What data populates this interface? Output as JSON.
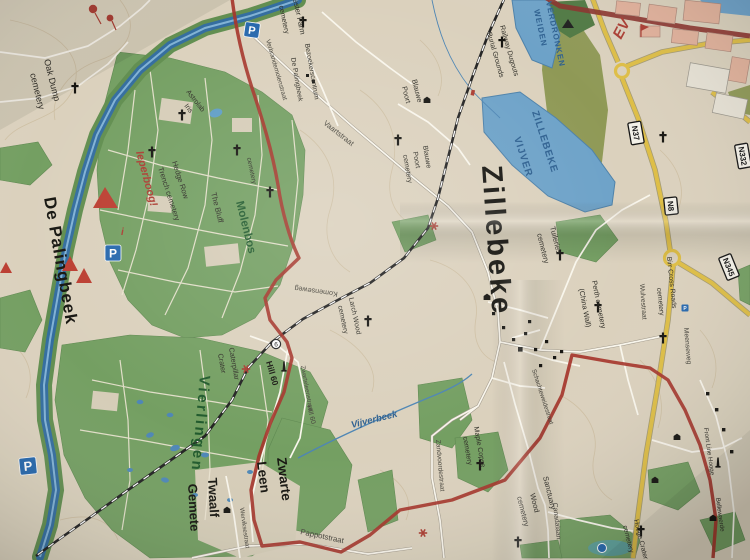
{
  "colors": {
    "paper": "#ddd3bd",
    "woods_green": "#72a05f",
    "olive_green": "#8f9a52",
    "water_blue": "#6aa3cc",
    "canal_blue": "#2f6da3",
    "route_red": "#aa3328",
    "road_yellow": "#e2bf3e",
    "city_pink": "#e6b29a",
    "railway_black": "#212121",
    "label_green": "#1d5a2a",
    "label_blue": "#2a6093",
    "label_red": "#b03a2e",
    "parking_blue": "#2268b2"
  },
  "badges": {
    "n37": "N37",
    "n8": "N8",
    "n345": "N345",
    "n332": "N332"
  },
  "parking": {
    "p": "P"
  },
  "info": {
    "i": "i",
    "poi_number": "6"
  },
  "places": {
    "zillebeke": "Zillebeke",
    "de_palingbeek": "De Palingbeek",
    "molenbos": "Molenbos",
    "vierlingen": "Vierlingen",
    "zwarte": "Zwarte",
    "leen": "Leen",
    "twaalf": "Twaalf",
    "gemete": "Gemete",
    "hill60_poi": "Hill 60",
    "caterpillar_1": "Caterpillar",
    "caterpillar_2": "Crater",
    "the_bluff": "The Bluff",
    "blauwe_farm_1": "Blauwe",
    "blauwe_farm_2": "Poort",
    "bezoekerscentrum_1": "Bezoekerscentrum",
    "bezoekerscentrum_2": "De Palingbeek",
    "astrolab_1": "Astrolab",
    "astrolab_2": "Iris",
    "ieperboog": "Ieperboog!",
    "ev": "EV",
    "front_line_hooge": "Front Line Hooge",
    "bellewaerde": "Bellewaerde"
  },
  "water": {
    "zillebeke_vijver_1": "ZILLEBEKE",
    "zillebeke_vijver_2": "VIJVER",
    "verdronken_1": "VERDRONKEN",
    "verdronken_2": "WEIDEN",
    "vijverbeek": "Vijverbeek"
  },
  "cemeteries": {
    "oak_dump_1": "Oak Dump",
    "oak_dump_2": "cemetery",
    "chester_1": "Chester Farm",
    "chester_2": "cemetery",
    "hedge_row_1": "Hedge Row",
    "hedge_row_2": "Trench cemetery",
    "woods": "cemetery",
    "blauwe_cem_1": "Blauwe",
    "blauwe_cem_2": "Poort",
    "blauwe_cem_3": "cemetery",
    "larch_1": "Larch Wood",
    "larch_2": "cemetery",
    "railway_dugouts_1": "Railway Dugouts",
    "railway_dugouts_2": "Burial Grounds",
    "tuileries_1": "Tuileries",
    "tuileries_2": "cemetery",
    "perth_1": "Perth cemetery",
    "perth_2": "(China Wall)",
    "birr_1": "Birr Cross Roads",
    "birr_2": "cemetery",
    "maple_1": "Maple Copse",
    "maple_2": "cemetery",
    "sanctuary_1": "Sanctuary",
    "sanctuary_2": "Wood",
    "sanctuary_3": "cemetery",
    "hooge_1": "Hooge Crater",
    "hooge_2": "cemetery"
  },
  "streets": {
    "vaartstraat": "Vaartstraat",
    "verbrandemolenstraat": "Verbrandemolenstraat",
    "komenseweg": "Komenseweg",
    "zwarteleenstraat": "Zwarteleenstraat",
    "hill60_street": "Hill 60",
    "pappotstraat": "Pappotstraat",
    "zandvoordestraat": "Zandvoordestraat",
    "schachteweidestraat": "Schachteweidestraat",
    "canadalaan": "Canadalaan",
    "wulvestraat": "Wulvestraat",
    "meenseweg": "Meenseweg",
    "werviksestraat": "Werviksestraat"
  }
}
